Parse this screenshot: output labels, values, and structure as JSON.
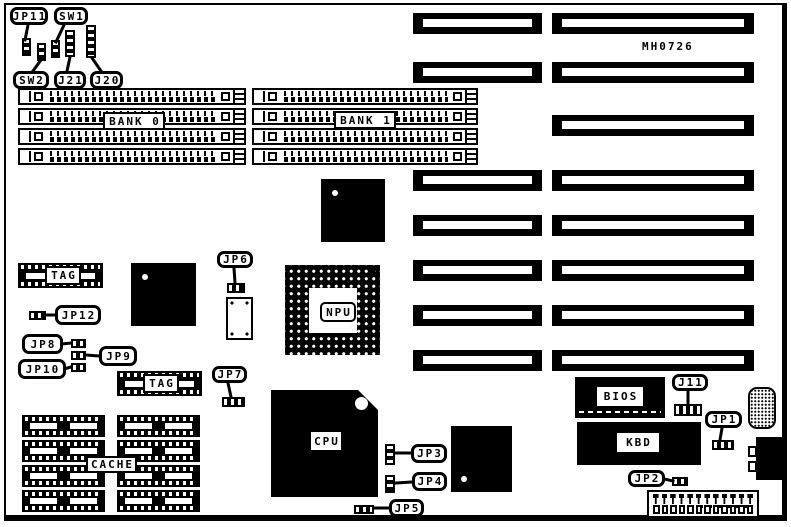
{
  "board": {
    "part_number": "MH0726"
  },
  "callouts": {
    "jp11": "JP11",
    "sw1": "SW1",
    "sw2": "SW2",
    "j21": "J21",
    "j20": "J20",
    "jp12": "JP12",
    "jp8": "JP8",
    "jp9": "JP9",
    "jp10": "JP10",
    "jp6": "JP6",
    "jp7": "JP7",
    "jp3": "JP3",
    "jp4": "JP4",
    "jp5": "JP5",
    "j11": "J11",
    "jp1": "JP1",
    "jp2": "JP2"
  },
  "components": {
    "bank0": "BANK 0",
    "bank1": "BANK 1",
    "tag_upper": "TAG",
    "tag_lower": "TAG",
    "cache": "CACHE",
    "npu": "NPU",
    "cpu": "CPU",
    "bios": "BIOS",
    "kbd": "KBD"
  },
  "memory": {
    "bank0_rows": 4,
    "bank1_rows": 4
  },
  "expansion_slots": {
    "left_column": 7,
    "right_column": 8
  },
  "cache_sockets": {
    "columns": 2,
    "rows": 4
  },
  "power_connector": {
    "pins": 12
  },
  "colors": {
    "ink": "#000000",
    "paper": "#ffffff"
  }
}
